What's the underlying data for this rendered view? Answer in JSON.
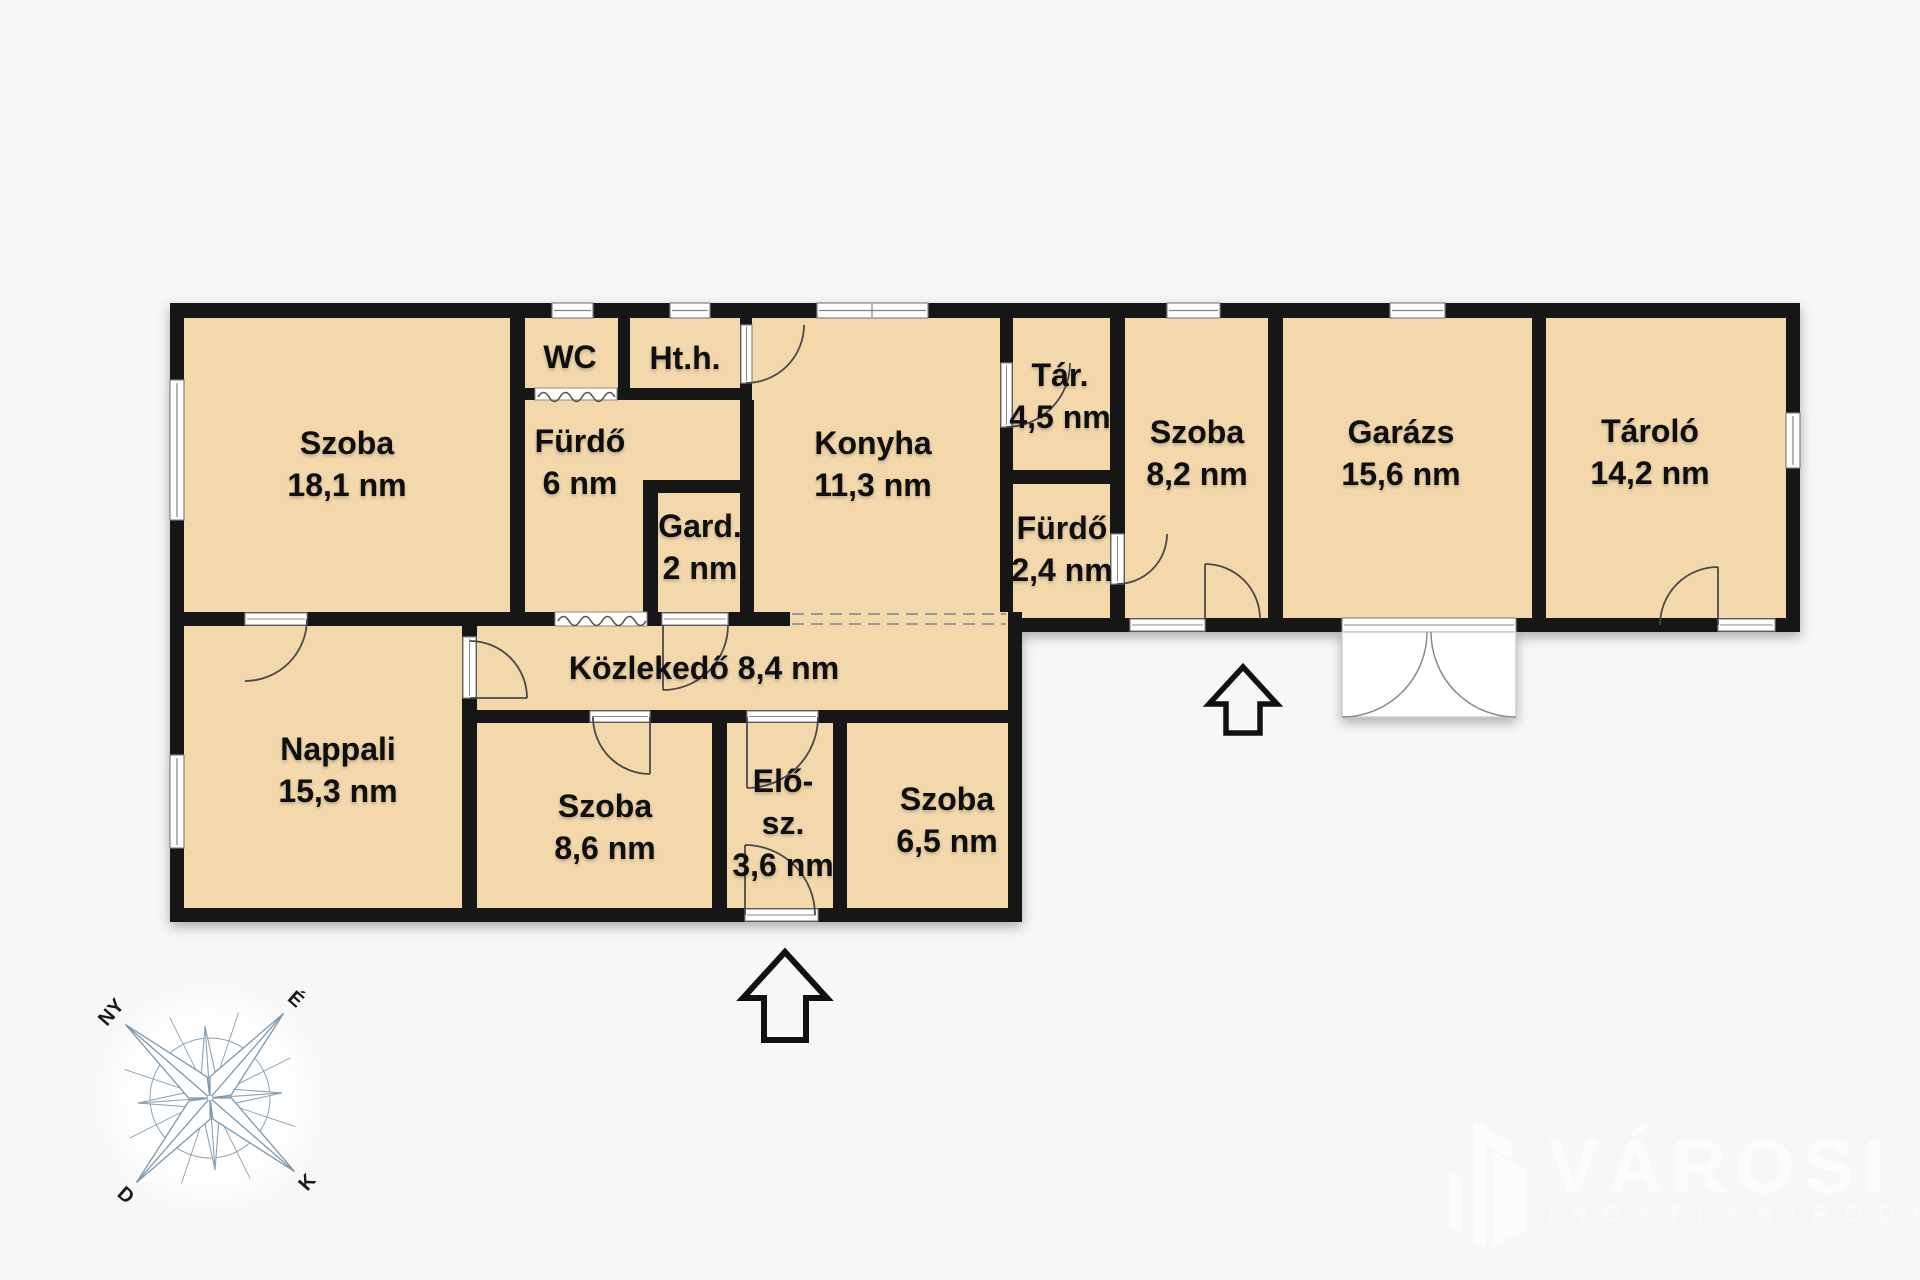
{
  "colors": {
    "background": "#f7f7f7",
    "floor": "#f2d8aa",
    "wall": "#161616",
    "label": "#0f0f0f",
    "door_arc": "#4a4a4a",
    "window_frame": "#828282",
    "compass_stroke": "#8ba2b5",
    "watermark": "#fcfcfc"
  },
  "units": "nm",
  "rooms": [
    {
      "id": "szoba-18-1",
      "lines": [
        "Szoba",
        "18,1 nm"
      ],
      "area_nm": 18.1
    },
    {
      "id": "wc",
      "lines": [
        "WC"
      ]
    },
    {
      "id": "hth",
      "lines": [
        "Ht.h."
      ]
    },
    {
      "id": "furdo-6",
      "lines": [
        "Fürdő",
        "6 nm"
      ],
      "area_nm": 6
    },
    {
      "id": "gard",
      "lines": [
        "Gard.",
        "2 nm"
      ],
      "area_nm": 2
    },
    {
      "id": "konyha",
      "lines": [
        "Konyha",
        "11,3 nm"
      ],
      "area_nm": 11.3
    },
    {
      "id": "tar",
      "lines": [
        "Tár.",
        "4,5 nm"
      ],
      "area_nm": 4.5
    },
    {
      "id": "furdo-2-4",
      "lines": [
        "Fürdő",
        "2,4 nm"
      ],
      "area_nm": 2.4
    },
    {
      "id": "szoba-8-2",
      "lines": [
        "Szoba",
        "8,2 nm"
      ],
      "area_nm": 8.2
    },
    {
      "id": "garazs",
      "lines": [
        "Garázs",
        "15,6 nm"
      ],
      "area_nm": 15.6
    },
    {
      "id": "tarolo",
      "lines": [
        "Tároló",
        "14,2 nm"
      ],
      "area_nm": 14.2
    },
    {
      "id": "nappali",
      "lines": [
        "Nappali",
        "15,3 nm"
      ],
      "area_nm": 15.3
    },
    {
      "id": "kozlekedo",
      "lines": [
        "Közlekedő 8,4 nm"
      ],
      "area_nm": 8.4
    },
    {
      "id": "szoba-8-6",
      "lines": [
        "Szoba",
        "8,6 nm"
      ],
      "area_nm": 8.6
    },
    {
      "id": "elosz",
      "lines": [
        "Elő-",
        "sz.",
        "3,6 nm"
      ],
      "area_nm": 3.6
    },
    {
      "id": "szoba-6-5",
      "lines": [
        "Szoba",
        "6,5 nm"
      ],
      "area_nm": 6.5
    }
  ],
  "compass": {
    "north": "É",
    "east": "K",
    "south": "D",
    "west": "NY"
  },
  "watermark": {
    "brand": "VÁROSI",
    "subtitle": "INGATLANIRODA"
  }
}
